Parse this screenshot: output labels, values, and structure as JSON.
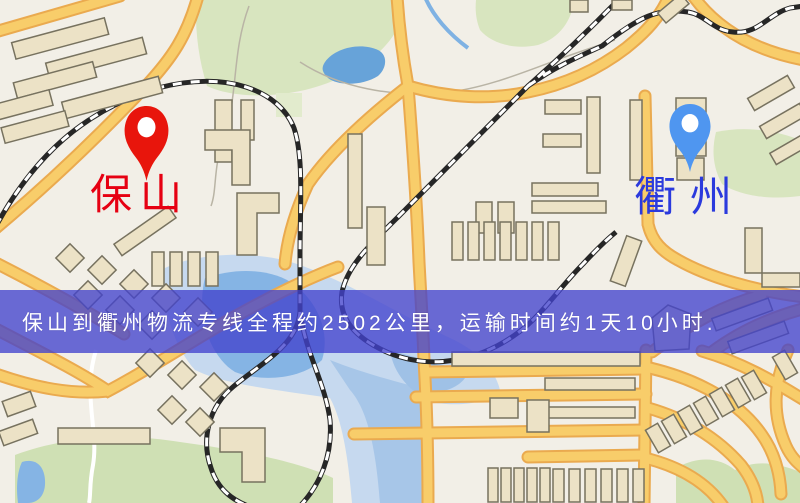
{
  "banner": {
    "text": "保山到衢州物流专线全程约2502公里，运输时间约1天10小时.",
    "background": "#4242cd",
    "text_color": "#ffffff"
  },
  "markers": {
    "origin": {
      "label": "保山",
      "label_color": "#e60012",
      "pin_color": "#e8150c"
    },
    "destination": {
      "label": "衢州",
      "label_color": "#2b3add",
      "pin_color": "#4f96f0"
    }
  },
  "map": {
    "background": "#f2efe7",
    "road": "#f8cd6a",
    "road_casing": "#eaaa4f",
    "park": "#d8e5bf",
    "water": "#85b4e4",
    "water_halo": "#c6d9ef",
    "building": "#ece2c6",
    "building_outline": "#77725f",
    "railway": "#262626"
  }
}
